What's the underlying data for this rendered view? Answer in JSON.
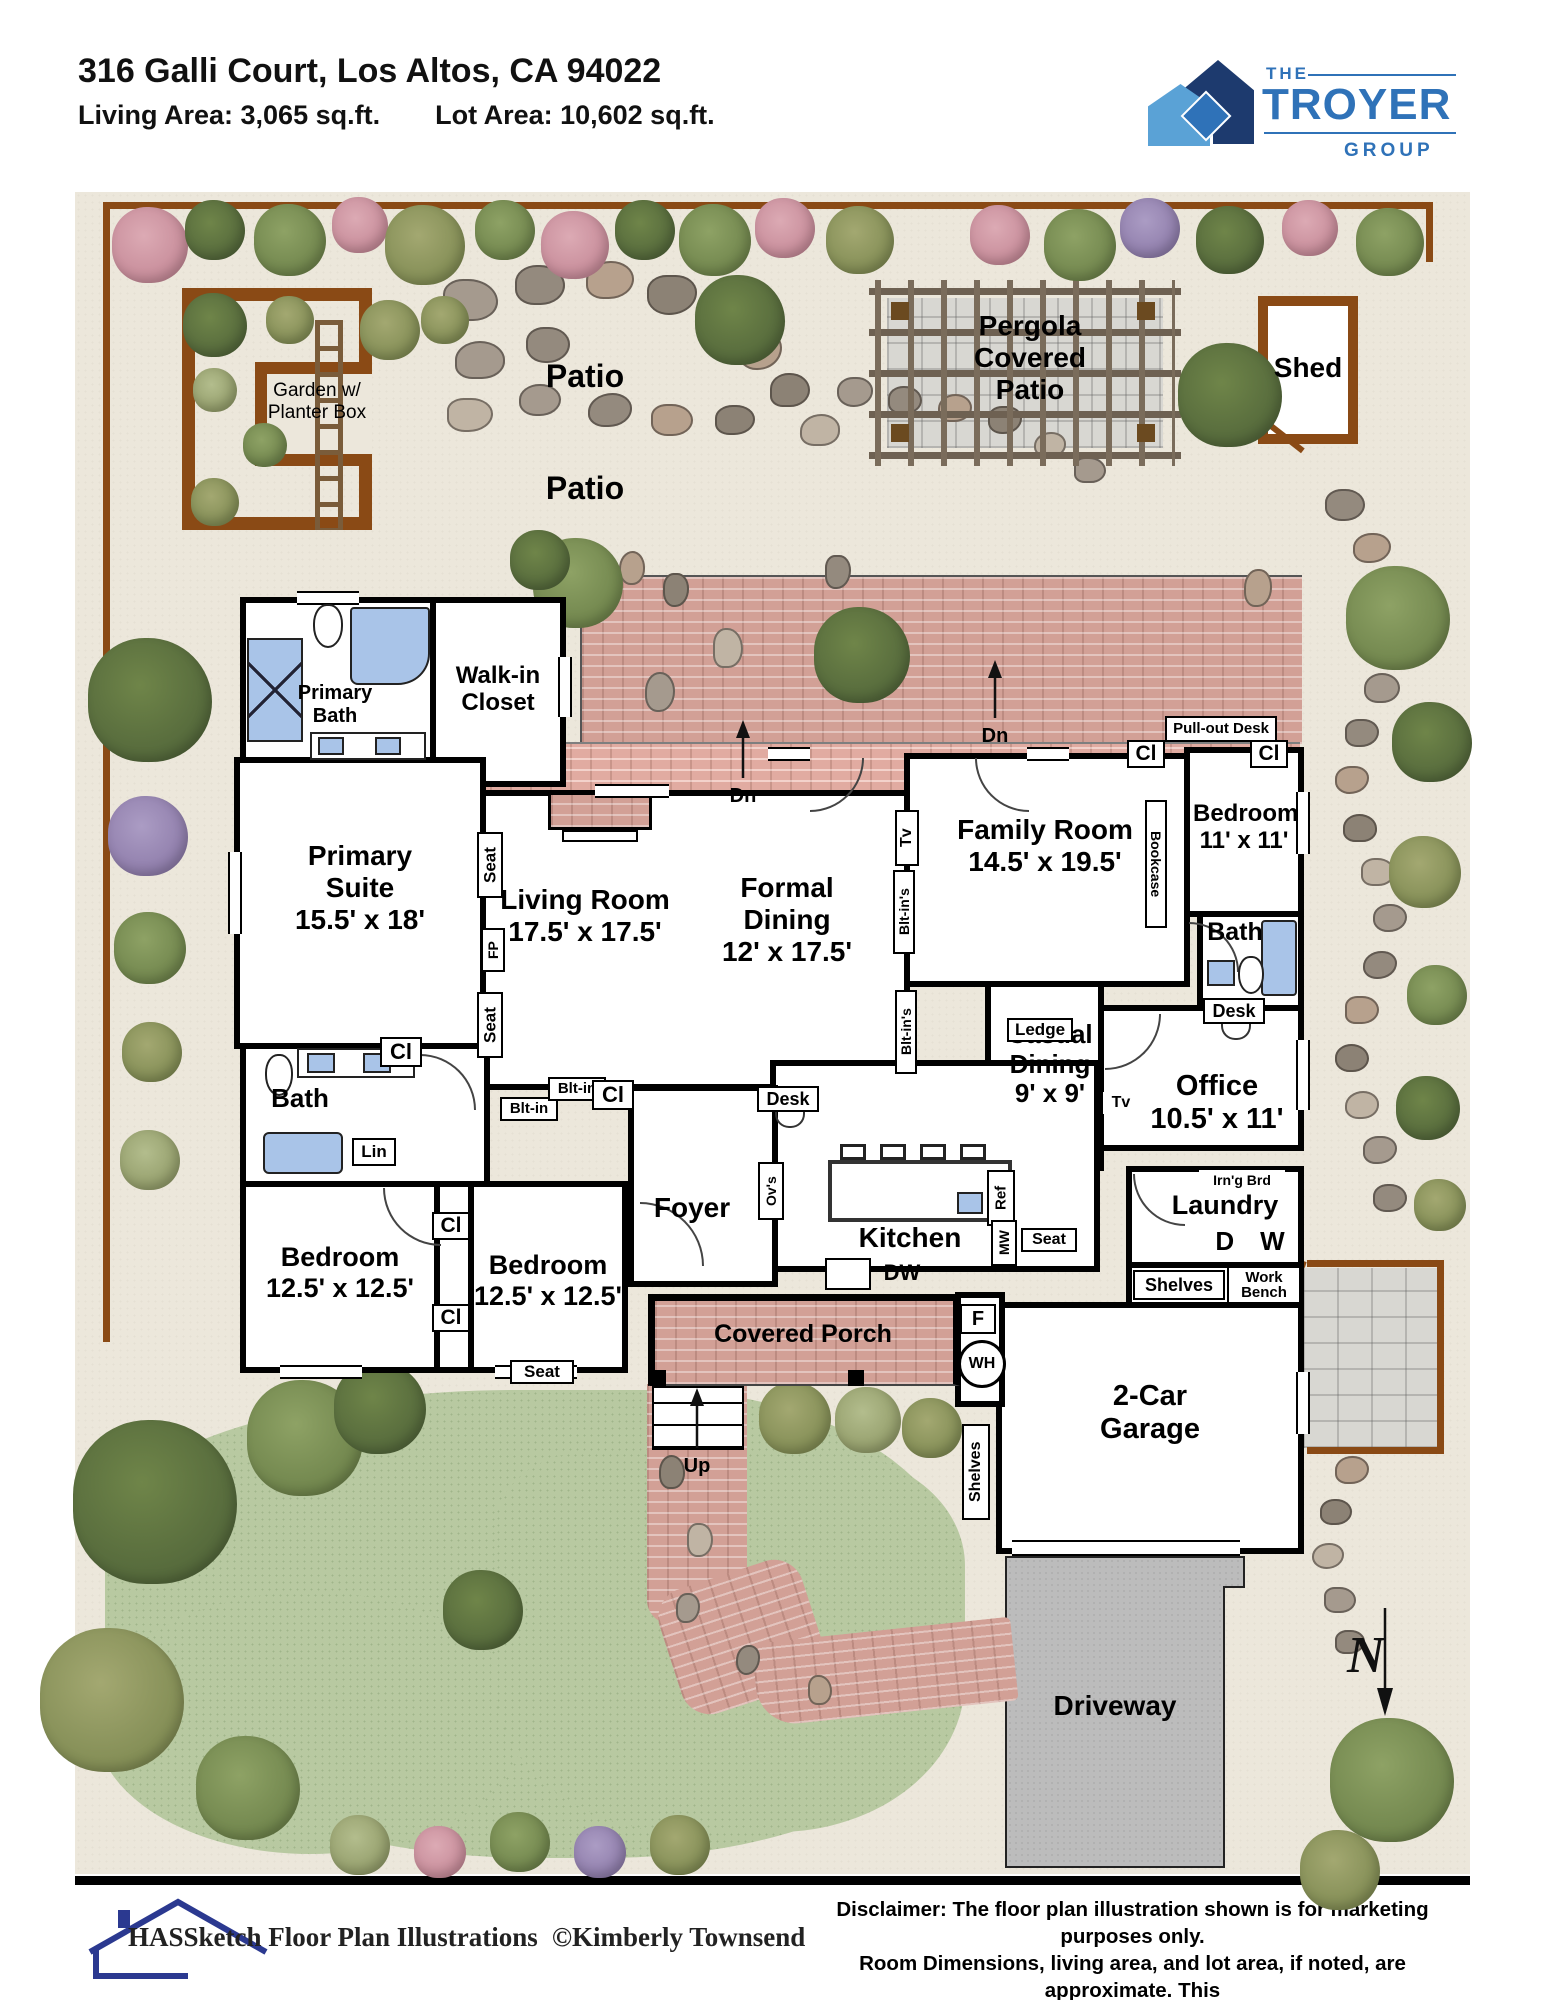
{
  "header": {
    "address": "316 Galli Court, Los Altos, CA 94022",
    "living_area": "Living Area: 3,065 sq.ft.",
    "lot_area": "Lot Area: 10,602 sq.ft."
  },
  "logo": {
    "the": "THE",
    "troyer": "TROYER",
    "group": "GROUP",
    "blue": "#2f72b8",
    "navy": "#1d3a6e",
    "light_blue": "#5aa2d6"
  },
  "site": {
    "garden": "Garden w/ Planter Box",
    "patio_top": "Patio",
    "pergola": "Pergola Covered Patio",
    "shed": "Shed",
    "patio_mid": "Patio",
    "driveway": "Driveway",
    "north": "N"
  },
  "rooms": {
    "primary_bath": {
      "name": "Primary Bath"
    },
    "walk_in_closet": {
      "name": "Walk-in Closet"
    },
    "primary_suite": {
      "name": "Primary Suite",
      "dims": "15.5' x 18'"
    },
    "living_room": {
      "name": "Living Room",
      "dims": "17.5' x 17.5'"
    },
    "formal_dining": {
      "name": "Formal Dining",
      "dims": "12' x 17.5'"
    },
    "family_room": {
      "name": "Family Room",
      "dims": "14.5' x 19.5'"
    },
    "bedroom_ne": {
      "name": "Bedroom",
      "dims": "11' x 11'"
    },
    "bath_ne": {
      "name": "Bath"
    },
    "office": {
      "name": "Office",
      "dims": "10.5' x 11'"
    },
    "casual_dining": {
      "name": "Casual Dining",
      "dims": "9' x 9'"
    },
    "kitchen": {
      "name": "Kitchen"
    },
    "foyer": {
      "name": "Foyer"
    },
    "bath_hall": {
      "name": "Bath"
    },
    "bedroom_sw": {
      "name": "Bedroom",
      "dims": "12.5' x 12.5'"
    },
    "bedroom_s": {
      "name": "Bedroom",
      "dims": "12.5' x 12.5'"
    },
    "laundry": {
      "name": "Laundry"
    },
    "garage": {
      "name": "2-Car Garage"
    },
    "covered_porch": {
      "name": "Covered Porch"
    }
  },
  "labels": {
    "pull_out_desk": "Pull-out Desk",
    "cl": "Cl",
    "bookcase": "Bookcase",
    "tv": "Tv",
    "blt_ins": "Blt-in's",
    "blt_in": "Blt-in",
    "seat": "Seat",
    "fp": "FP",
    "desk": "Desk",
    "ledge": "Ledge",
    "lin": "Lin",
    "dn": "Dn",
    "up": "Up",
    "ovs": "Ov's",
    "dw": "DW",
    "ref": "Ref",
    "mw": "MW",
    "irng_brd": "Irn'g Brd",
    "d": "D",
    "w": "W",
    "f": "F",
    "wh": "WH",
    "shelves": "Shelves",
    "work_bench": "Work Bench"
  },
  "footer": {
    "brand": "HASSketch Floor Plan Illustrations",
    "copyright": "©Kimberly Townsend",
    "disclaimer1": "Disclaimer: The floor plan illustration shown is for marketing purposes only.",
    "disclaimer2": "Room Dimensions, living area, and lot area, if noted, are approximate. This",
    "disclaimer3": "Illustration is deemed reliable, however is not guaranteed. Buyer to verify."
  }
}
